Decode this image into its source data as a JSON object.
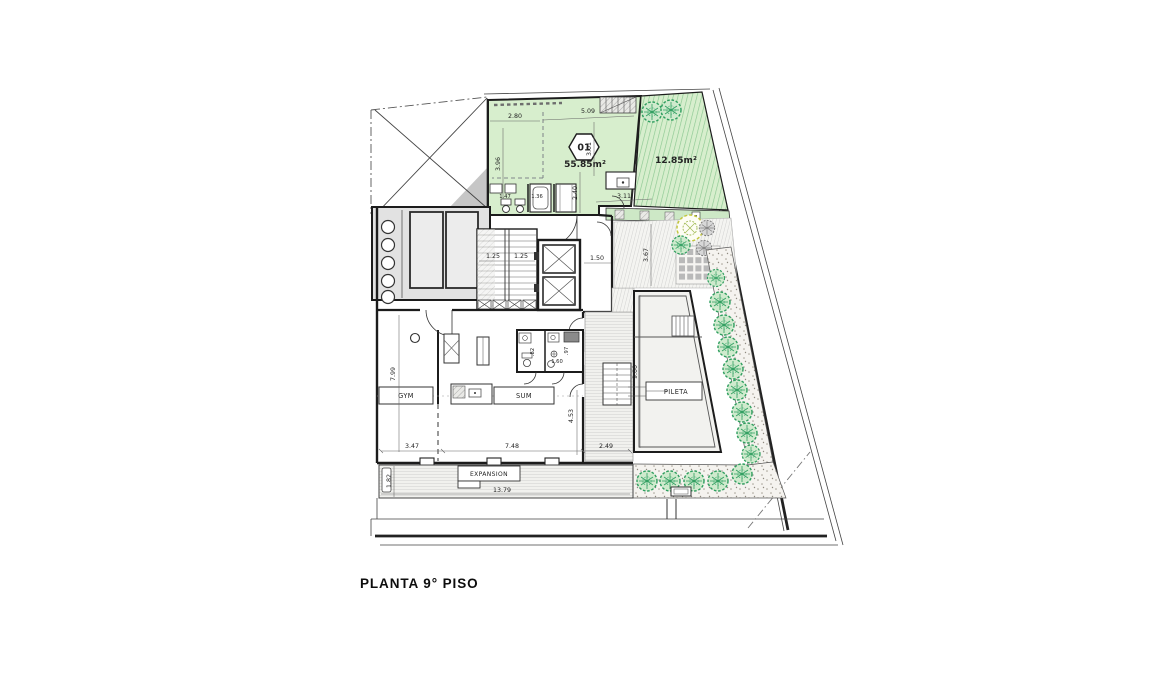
{
  "title": "PLANTA 9° PISO",
  "plan": {
    "unit01": {
      "number": "01",
      "area": "55.85m²"
    },
    "terrace": {
      "area": "12.85m²"
    },
    "rooms": {
      "gym": "GYM",
      "sum": "SUM",
      "pool": "PILETA",
      "expansion": "EXPANSION"
    },
    "dims": {
      "apt_top_left": "2.80",
      "apt_top_right": "5.09",
      "apt_left": "3.96",
      "apt_mid": "3.01",
      "apt_low": "2.40",
      "apt_bottom": "3.11",
      "bath_a": "1.47",
      "bath_b": "1.36",
      "stair_a": "1.25",
      "stair_b": "1.25",
      "hall": "1.50",
      "deck_top": "3.67",
      "gym_height": "7.99",
      "sum_right": "4.53",
      "pool_height": "9.00",
      "wc_w": ".82",
      "wc_mid": "1.60",
      "wc_e": ".97",
      "bottom_a": "3.47",
      "bottom_b": "7.48",
      "bottom_c": "2.49",
      "exp_height": "1.82",
      "exp_width": "13.79"
    }
  },
  "colors": {
    "unit_green": "#d7eecd",
    "stripe_green": "#8cc892",
    "tree_green": "#2f9e5f",
    "wall": "#1c1c1c"
  }
}
